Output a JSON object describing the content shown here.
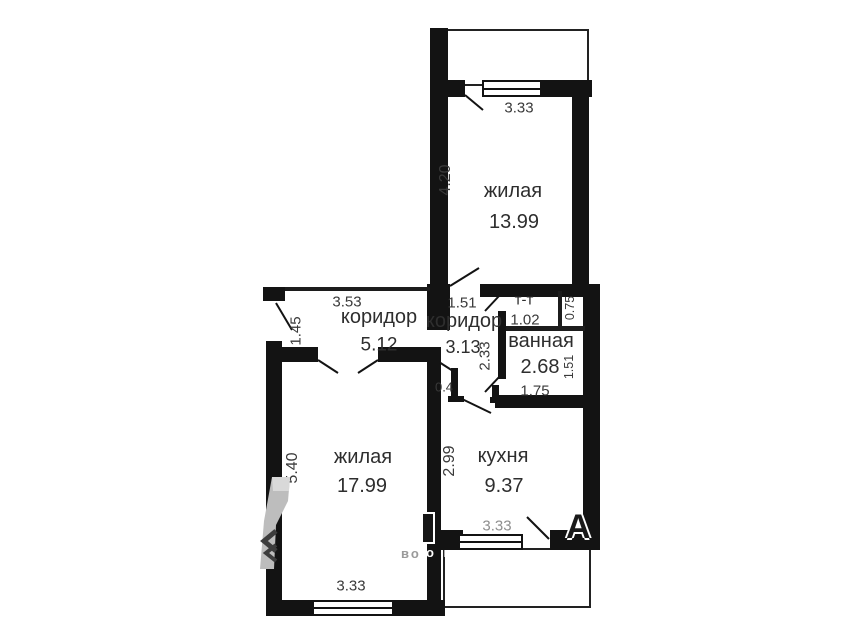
{
  "plan": {
    "title": "apartment floor plan",
    "rooms": [
      {
        "id": "living1",
        "name": "жилая",
        "area": "13.99"
      },
      {
        "id": "hall1",
        "name": "коридор",
        "area": "5.12"
      },
      {
        "id": "hall2",
        "name": "коридор",
        "area": "3.13"
      },
      {
        "id": "wc",
        "name": "т-т",
        "area": ""
      },
      {
        "id": "bath",
        "name": "ванная",
        "area": "2.68"
      },
      {
        "id": "living2",
        "name": "жилая",
        "area": "17.99"
      },
      {
        "id": "kitchen",
        "name": "кухня",
        "area": "9.37"
      }
    ],
    "dims": {
      "living1_w": "3.33",
      "living1_h": "4.20",
      "hall1_w": "3.53",
      "entry_h": "1.45",
      "hall2_w": "1.51",
      "hall2_h": "2.33",
      "wc_w": "1.02",
      "shaft_h": "0.75",
      "bath_w": "1.75",
      "bath_h": "1.51",
      "wall_stub": "0.4",
      "living2_w": "3.33",
      "living2_h": "5.40",
      "kitchen_w": "3.33",
      "kitchen_h": "2.99"
    },
    "watermark": {
      "big_letter": "А",
      "small_text": "о недвижимости",
      "left_fragment": "во"
    },
    "colors": {
      "wall": "#131313",
      "dim_text": "#3a3a3a",
      "room_text": "#2e2e2e",
      "watermark_grey": "#bdbdbd"
    }
  }
}
